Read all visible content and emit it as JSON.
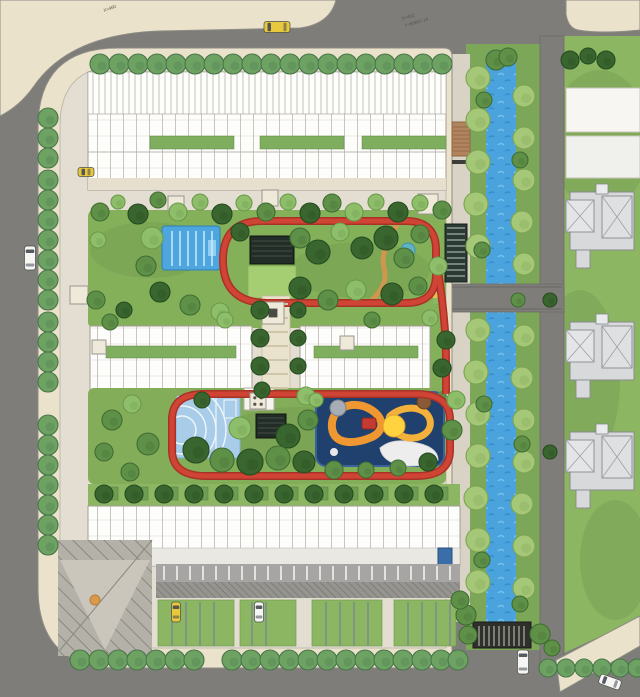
{
  "annotations": {
    "coord_a1": "X=462",
    "coord_a2": "Y=83657.14",
    "coord_b": "X=460"
  },
  "colors": {
    "road": "#7e7d79",
    "sidewalk": "#eae2ca",
    "site_paving": "#e4ded2",
    "lawn": "#8cb661",
    "bank_green": "#7ca758",
    "river": "#4aa3dc",
    "track": "#c0392b",
    "building_white": "#fdfdfb",
    "roof_gray": "#d8d9db",
    "pool_blue": "#4da6dd",
    "court_blue": "#a9cde9",
    "playground_base": "#20406e",
    "playground_path": "#ef9730",
    "pavilion_dark": "#222d27",
    "deck_wood": "#b2845e",
    "taxi_yellow": "#e8c83c",
    "car_white": "#f5f5f3"
  },
  "scene": {
    "palettes": {
      "street": [
        "#6ea263",
        "#49764a"
      ],
      "bank": [
        "#a5c878",
        "#7da451"
      ],
      "mid": [
        "#5f9048",
        "#3f6d32"
      ],
      "dark": [
        "#39652f",
        "#264b21"
      ],
      "light": [
        "#8fbe6a",
        "#699a4b"
      ]
    },
    "tree_groups": [
      {
        "name": "street-top",
        "palette": "street",
        "r": 10,
        "items": [
          [
            100,
            64
          ],
          [
            119,
            64
          ],
          [
            138,
            64
          ],
          [
            157,
            64
          ],
          [
            176,
            64
          ],
          [
            195,
            64
          ],
          [
            214,
            64
          ],
          [
            233,
            64
          ],
          [
            252,
            64
          ],
          [
            271,
            64
          ],
          [
            290,
            64
          ],
          [
            309,
            64
          ],
          [
            328,
            64
          ],
          [
            347,
            64
          ],
          [
            366,
            64
          ],
          [
            385,
            64
          ],
          [
            404,
            64
          ],
          [
            423,
            64
          ],
          [
            442,
            64
          ]
        ]
      },
      {
        "name": "street-left",
        "palette": "street",
        "r": 10,
        "items": [
          [
            48,
            118
          ],
          [
            48,
            138
          ],
          [
            48,
            158
          ],
          [
            48,
            180
          ],
          [
            48,
            200
          ],
          [
            48,
            220
          ],
          [
            48,
            240
          ],
          [
            48,
            260
          ],
          [
            48,
            280
          ],
          [
            48,
            300
          ],
          [
            48,
            322
          ],
          [
            48,
            342
          ],
          [
            48,
            362
          ],
          [
            48,
            382
          ],
          [
            48,
            425
          ],
          [
            48,
            445
          ],
          [
            48,
            465
          ],
          [
            48,
            485
          ],
          [
            48,
            505
          ],
          [
            48,
            525
          ],
          [
            48,
            545
          ]
        ]
      },
      {
        "name": "street-bottom",
        "palette": "street",
        "r": 10,
        "items": [
          [
            80,
            660
          ],
          [
            99,
            660
          ],
          [
            118,
            660
          ],
          [
            137,
            660
          ],
          [
            156,
            660
          ],
          [
            175,
            660
          ],
          [
            194,
            660
          ],
          [
            232,
            660
          ],
          [
            251,
            660
          ],
          [
            270,
            660
          ],
          [
            289,
            660
          ],
          [
            308,
            660
          ],
          [
            327,
            660
          ],
          [
            346,
            660
          ],
          [
            365,
            660
          ],
          [
            384,
            660
          ],
          [
            403,
            660
          ],
          [
            422,
            660
          ],
          [
            441,
            660
          ],
          [
            458,
            660
          ]
        ]
      },
      {
        "name": "street-bottom-right",
        "palette": "street",
        "r": 9,
        "items": [
          [
            548,
            668
          ],
          [
            566,
            668
          ],
          [
            584,
            668
          ],
          [
            602,
            668
          ],
          [
            620,
            668
          ],
          [
            637,
            668
          ]
        ]
      },
      {
        "name": "bank-west",
        "palette": "bank",
        "r": 12,
        "items": [
          [
            478,
            78
          ],
          [
            478,
            120
          ],
          [
            478,
            162
          ],
          [
            476,
            204
          ],
          [
            478,
            246
          ],
          [
            478,
            330
          ],
          [
            476,
            372
          ],
          [
            478,
            414
          ],
          [
            478,
            456
          ],
          [
            476,
            498
          ],
          [
            478,
            540
          ],
          [
            478,
            582
          ]
        ]
      },
      {
        "name": "bank-east",
        "palette": "bank",
        "r": 11,
        "items": [
          [
            524,
            96
          ],
          [
            524,
            138
          ],
          [
            524,
            180
          ],
          [
            522,
            222
          ],
          [
            524,
            264
          ],
          [
            524,
            336
          ],
          [
            522,
            378
          ],
          [
            524,
            420
          ],
          [
            524,
            462
          ],
          [
            522,
            504
          ],
          [
            524,
            546
          ],
          [
            524,
            588
          ]
        ]
      },
      {
        "name": "bank-accent",
        "palette": "mid",
        "r": 9,
        "items": [
          [
            484,
            100,
            8
          ],
          [
            482,
            250,
            8
          ],
          [
            484,
            404,
            8
          ],
          [
            482,
            560,
            8
          ],
          [
            520,
            160,
            8
          ],
          [
            518,
            300,
            7
          ],
          [
            522,
            444,
            8
          ],
          [
            520,
            604,
            8
          ],
          [
            496,
            60,
            10
          ],
          [
            508,
            57,
            9
          ]
        ]
      },
      {
        "name": "right-lawn",
        "palette": "dark",
        "r": 9,
        "items": [
          [
            570,
            60
          ],
          [
            588,
            56,
            8
          ],
          [
            606,
            60
          ],
          [
            550,
            300,
            7
          ],
          [
            550,
            452,
            7
          ]
        ]
      },
      {
        "name": "garden-dark",
        "palette": "dark",
        "r": 10,
        "items": [
          [
            138,
            214
          ],
          [
            222,
            214
          ],
          [
            310,
            213
          ],
          [
            398,
            212
          ],
          [
            240,
            232,
            9
          ],
          [
            318,
            252,
            12
          ],
          [
            386,
            238,
            12
          ],
          [
            300,
            288,
            11
          ],
          [
            392,
            294,
            11
          ],
          [
            160,
            292
          ],
          [
            362,
            248,
            11
          ],
          [
            196,
            450,
            13
          ],
          [
            250,
            462,
            13
          ],
          [
            304,
            462,
            11
          ],
          [
            288,
            436,
            12
          ],
          [
            202,
            400,
            8
          ],
          [
            428,
            462,
            9
          ],
          [
            260,
            310,
            9
          ],
          [
            298,
            310,
            8
          ],
          [
            260,
            338,
            9
          ],
          [
            298,
            338,
            8
          ],
          [
            260,
            366,
            9
          ],
          [
            298,
            366,
            8
          ],
          [
            262,
            390,
            8
          ],
          [
            442,
            368,
            9
          ],
          [
            124,
            310,
            8
          ],
          [
            446,
            340,
            9
          ]
        ]
      },
      {
        "name": "garden-mid",
        "palette": "mid",
        "r": 9,
        "items": [
          [
            100,
            212
          ],
          [
            158,
            200,
            8
          ],
          [
            266,
            212
          ],
          [
            332,
            203
          ],
          [
            442,
            210
          ],
          [
            146,
            266,
            10
          ],
          [
            190,
            305,
            10
          ],
          [
            300,
            238,
            10
          ],
          [
            420,
            234
          ],
          [
            328,
            300,
            10
          ],
          [
            418,
            286
          ],
          [
            96,
            300
          ],
          [
            112,
            420,
            10
          ],
          [
            148,
            444,
            11
          ],
          [
            222,
            460,
            12
          ],
          [
            278,
            458,
            12
          ],
          [
            130,
            472,
            9
          ],
          [
            308,
            420,
            10
          ],
          [
            334,
            470,
            9
          ],
          [
            398,
            468,
            8
          ],
          [
            452,
            430,
            10
          ],
          [
            110,
            322,
            8
          ],
          [
            372,
            320,
            8
          ],
          [
            104,
            452,
            9
          ],
          [
            366,
            470,
            8
          ],
          [
            404,
            258,
            10
          ]
        ]
      },
      {
        "name": "garden-light",
        "palette": "light",
        "r": 9,
        "items": [
          [
            118,
            202,
            7
          ],
          [
            178,
            212
          ],
          [
            200,
            202,
            8
          ],
          [
            244,
            203,
            8
          ],
          [
            288,
            202,
            8
          ],
          [
            354,
            212
          ],
          [
            376,
            202,
            8
          ],
          [
            420,
            203,
            8
          ],
          [
            152,
            238,
            11
          ],
          [
            220,
            312,
            9
          ],
          [
            340,
            232
          ],
          [
            356,
            290,
            10
          ],
          [
            438,
            266
          ],
          [
            98,
            240,
            8
          ],
          [
            240,
            428,
            11
          ],
          [
            132,
            404,
            9
          ],
          [
            306,
            396
          ],
          [
            316,
            400,
            7
          ],
          [
            456,
            400,
            9
          ],
          [
            225,
            320,
            8
          ],
          [
            430,
            318,
            8
          ]
        ]
      },
      {
        "name": "townhouse-row",
        "palette": "dark",
        "r": 9,
        "items": [
          [
            104,
            494
          ],
          [
            134,
            494
          ],
          [
            164,
            494
          ],
          [
            194,
            494
          ],
          [
            224,
            494
          ],
          [
            254,
            494
          ],
          [
            284,
            494
          ],
          [
            314,
            494
          ],
          [
            344,
            494
          ],
          [
            374,
            494
          ],
          [
            404,
            494
          ],
          [
            434,
            494
          ]
        ]
      },
      {
        "name": "southeast",
        "palette": "mid",
        "r": 9,
        "items": [
          [
            466,
            615,
            10
          ],
          [
            460,
            600
          ],
          [
            468,
            635
          ],
          [
            540,
            634,
            10
          ],
          [
            552,
            648,
            8
          ]
        ]
      }
    ],
    "line_groups": [
      {
        "name": "aisle-stalls",
        "orient": "v",
        "a": 566,
        "b": 580,
        "pos": [
          164,
          177,
          190,
          203,
          216,
          229,
          242,
          255,
          268,
          281,
          294,
          307,
          320,
          333,
          346,
          359,
          372,
          385,
          398,
          411,
          424,
          437,
          450
        ],
        "color": "#f2f1ee",
        "w": 1.6
      },
      {
        "name": "bay-dividers",
        "orient": "v",
        "a": 602,
        "b": 646,
        "pos": [
          172,
          186,
          200,
          214,
          252,
          266,
          326,
          340,
          354,
          368,
          408,
          422,
          436,
          450
        ],
        "color": "#7b8894",
        "w": 1.4
      },
      {
        "name": "axis-rungs",
        "orient": "h",
        "a": 264,
        "b": 288,
        "pos": [
          304,
          318,
          332,
          346,
          360,
          374,
          388
        ],
        "color": "#cfc5aa",
        "w": 2
      },
      {
        "name": "bridge-stripes",
        "orient": "v",
        "a": 626,
        "b": 646,
        "pos": [
          479,
          484,
          489,
          494,
          499,
          504,
          509,
          514,
          519,
          524
        ],
        "color": "#7e7d75",
        "w": 2
      },
      {
        "name": "pergola-slats",
        "orient": "h",
        "a": 447,
        "b": 465,
        "pos": [
          228,
          234,
          240,
          246,
          252,
          258,
          264,
          270,
          276
        ],
        "color": "#9fb0a6",
        "w": 1.2
      },
      {
        "name": "pool-lanes",
        "orient": "v",
        "a": 231,
        "b": 266,
        "pos": [
          172,
          180,
          188,
          196,
          204,
          212
        ],
        "color": "#cfe9fa",
        "w": 1.5
      },
      {
        "name": "crossing-railings",
        "orient": "h",
        "a": 452,
        "b": 562,
        "pos": [
          287,
          309
        ],
        "color": "#6e6d68",
        "w": 1.2
      },
      {
        "name": "deck-planks",
        "orient": "h",
        "a": 453,
        "b": 469,
        "pos": [
          127,
          131,
          135,
          139,
          143,
          147,
          151
        ],
        "color": "#8a6544",
        "w": 0.8
      },
      {
        "name": "pavilion-upper-slats",
        "orient": "h",
        "a": 252,
        "b": 292,
        "pos": [
          241,
          246,
          251,
          256
        ],
        "color": "#3c4a40",
        "w": 1.3
      },
      {
        "name": "pavilion-lower-slats",
        "orient": "h",
        "a": 258,
        "b": 284,
        "pos": [
          418,
          423,
          428,
          433
        ],
        "color": "#3c4a40",
        "w": 1.3
      }
    ],
    "pads": [
      [
        168,
        196,
        16
      ],
      [
        262,
        190,
        16
      ],
      [
        418,
        194,
        20
      ],
      [
        70,
        286,
        18
      ],
      [
        262,
        302,
        22,
        "inner"
      ],
      [
        250,
        393,
        16,
        "dots"
      ],
      [
        92,
        340,
        14
      ],
      [
        340,
        336,
        14
      ]
    ],
    "car_colors": {
      "taxi": "#e8c83c",
      "white": "#f5f5f3"
    },
    "cars": [
      {
        "name": "taxi-top-road",
        "x": 277,
        "y": 27,
        "angle": 0,
        "len": 26,
        "wid": 11,
        "color": "taxi"
      },
      {
        "name": "car-west-road",
        "x": 30,
        "y": 258,
        "angle": 90,
        "len": 24,
        "wid": 11,
        "color": "white"
      },
      {
        "name": "parked-car-northwest",
        "x": 86,
        "y": 172,
        "angle": 0,
        "len": 16,
        "wid": 9,
        "color": "taxi"
      },
      {
        "name": "parked-car-south-1",
        "x": 176,
        "y": 612,
        "angle": 90,
        "len": 20,
        "wid": 9,
        "color": "taxi"
      },
      {
        "name": "parked-car-south-2",
        "x": 259,
        "y": 612,
        "angle": 90,
        "len": 20,
        "wid": 9,
        "color": "white"
      },
      {
        "name": "car-south-road",
        "x": 523,
        "y": 662,
        "angle": 90,
        "len": 24,
        "wid": 11,
        "color": "white"
      },
      {
        "name": "car-southeast-road",
        "x": 610,
        "y": 682,
        "angle": 20,
        "len": 22,
        "wid": 10,
        "color": "white"
      }
    ]
  }
}
